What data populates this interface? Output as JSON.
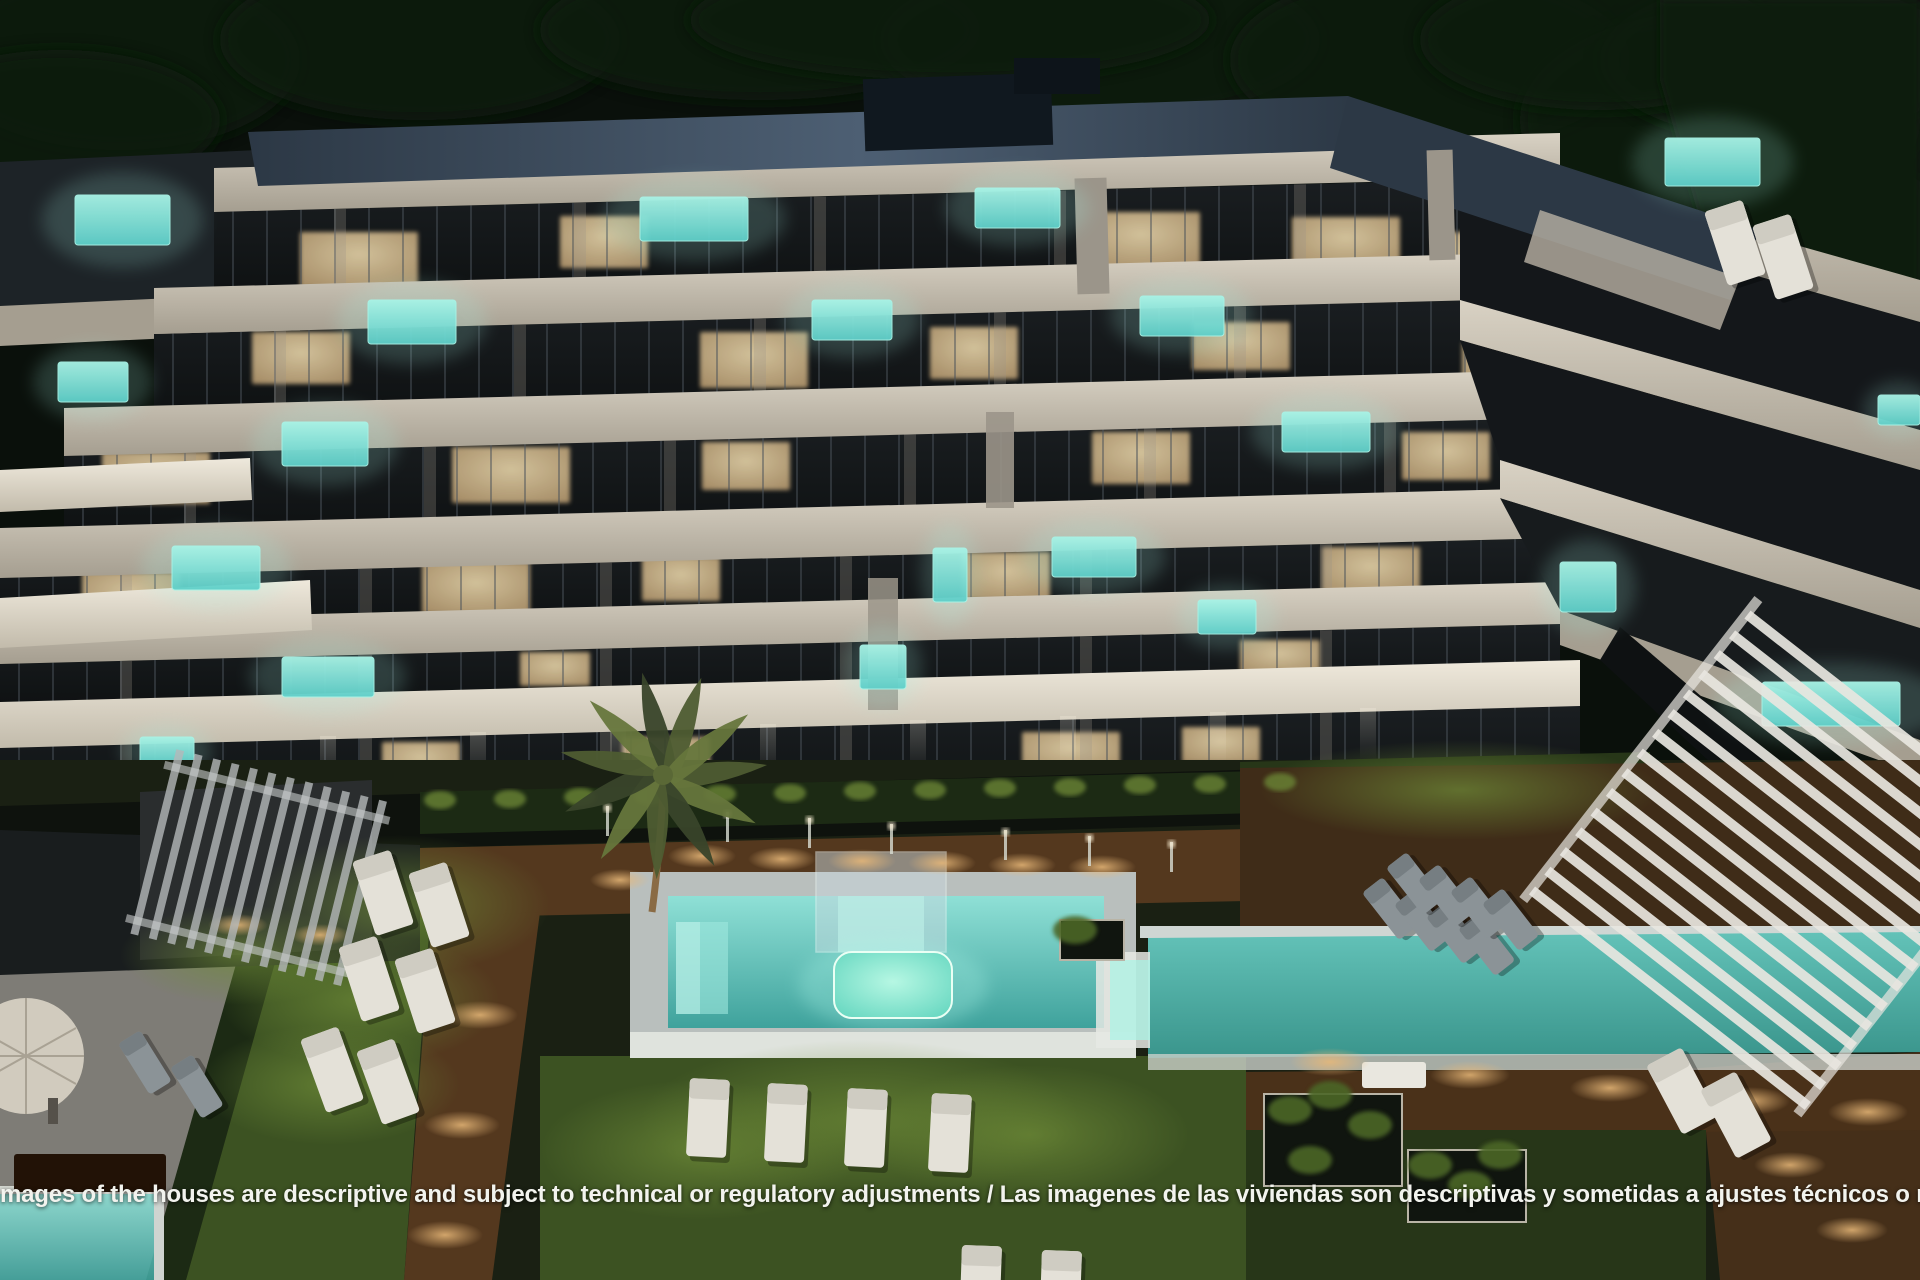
{
  "image_description": "Night aerial rendering of a modern white apartment complex with terraced balconies, plunge pools, communal swimming pools, lap pool, pergolas, palm tree, lawns and sun loungers",
  "disclaimer": {
    "text": "mages of the houses are descriptive and subject to technical or regulatory adjustments / Las imagenes de las viviendas son descriptivas y sometidas a ajustes técnicos o norm"
  },
  "palette": {
    "sky": "#0a100b",
    "tree": "#101c11",
    "roof1": "#4d5f73",
    "roof2": "#2c3845",
    "slab": "#d9d2c4",
    "slabDim": "#a59e90",
    "slabBright": "#efe9dc",
    "glass": "#14171a",
    "mullion": "#4a525a",
    "pier": "#9b958a",
    "warm1": "#e6d3a8",
    "warm2": "#b1946a",
    "pool": "#5ecfc9",
    "poolGlow": "#a8f3e6",
    "poolDeep": "#2f9b95",
    "lawn": "#3c5222",
    "lawnLit": "#5d7a2f",
    "lawnDark": "#273618",
    "deck": "#54381e",
    "deckLit": "#b9813f",
    "paving": "#7e7c76",
    "hedge": "#1c2a14",
    "hedgeLit": "#6a8434",
    "pergolaWhite": "#e8e6df",
    "pergolaGray": "#b4b8b9",
    "lounger": "#e4e1d8",
    "loungerGray": "#8b9397",
    "copingWhite": "#dfe3dd",
    "text": "#f2f3ee"
  },
  "scene": {
    "glass_bands": [
      [
        214,
        212,
        1346,
        76
      ],
      [
        154,
        334,
        1406,
        74
      ],
      [
        64,
        456,
        1496,
        72
      ],
      [
        0,
        578,
        1560,
        44
      ],
      [
        0,
        664,
        1560,
        38
      ],
      [
        0,
        746,
        1580,
        60
      ]
    ],
    "plunge_pools": [
      [
        75,
        195,
        95,
        50
      ],
      [
        640,
        197,
        108,
        44
      ],
      [
        975,
        188,
        85,
        40
      ],
      [
        1665,
        138,
        95,
        48
      ],
      [
        368,
        300,
        88,
        44
      ],
      [
        812,
        300,
        80,
        40
      ],
      [
        1140,
        296,
        84,
        40
      ],
      [
        58,
        362,
        70,
        40
      ],
      [
        282,
        422,
        86,
        44
      ],
      [
        933,
        548,
        34,
        54
      ],
      [
        1282,
        412,
        88,
        40
      ],
      [
        172,
        546,
        88,
        44
      ],
      [
        1052,
        537,
        84,
        40
      ],
      [
        860,
        645,
        46,
        44
      ],
      [
        1198,
        600,
        58,
        34
      ],
      [
        1560,
        562,
        56,
        50
      ],
      [
        1762,
        682,
        138,
        44
      ],
      [
        1878,
        395,
        42,
        30
      ],
      [
        282,
        657,
        92,
        40
      ],
      [
        140,
        737,
        54,
        28
      ]
    ],
    "lit_windows": [
      [
        300,
        232,
        118,
        56
      ],
      [
        560,
        216,
        88,
        52
      ],
      [
        1082,
        212,
        118,
        56
      ],
      [
        1292,
        217,
        108,
        52
      ],
      [
        1432,
        232,
        78,
        48
      ],
      [
        252,
        332,
        98,
        52
      ],
      [
        700,
        332,
        108,
        56
      ],
      [
        930,
        327,
        88,
        52
      ],
      [
        1192,
        322,
        98,
        48
      ],
      [
        1462,
        342,
        88,
        48
      ],
      [
        102,
        452,
        108,
        52
      ],
      [
        452,
        447,
        118,
        56
      ],
      [
        702,
        442,
        88,
        48
      ],
      [
        1092,
        432,
        98,
        52
      ],
      [
        1402,
        432,
        88,
        48
      ],
      [
        82,
        572,
        98,
        48
      ],
      [
        422,
        562,
        108,
        52
      ],
      [
        642,
        557,
        78,
        44
      ],
      [
        962,
        552,
        88,
        48
      ],
      [
        1322,
        547,
        98,
        48
      ],
      [
        520,
        652,
        70,
        34
      ],
      [
        1240,
        640,
        80,
        34
      ],
      [
        382,
        742,
        78,
        38
      ],
      [
        622,
        737,
        88,
        40
      ],
      [
        1022,
        732,
        98,
        40
      ],
      [
        1182,
        727,
        78,
        36
      ],
      [
        1700,
        472,
        88,
        44
      ],
      [
        1642,
        382,
        68,
        38
      ]
    ],
    "facade_streaks": [
      [
        320,
        736
      ],
      [
        470,
        732
      ],
      [
        610,
        728
      ],
      [
        760,
        724
      ],
      [
        910,
        720
      ],
      [
        1060,
        716
      ],
      [
        1210,
        712
      ],
      [
        1360,
        708
      ]
    ],
    "deck_lights": [
      [
        702,
        856,
        34,
        12
      ],
      [
        782,
        859,
        34,
        12
      ],
      [
        862,
        861,
        34,
        12
      ],
      [
        942,
        863,
        34,
        12
      ],
      [
        1022,
        865,
        34,
        12
      ],
      [
        1102,
        867,
        34,
        12
      ],
      [
        480,
        1015,
        38,
        14
      ],
      [
        462,
        1125,
        38,
        14
      ],
      [
        445,
        1235,
        38,
        14
      ],
      [
        1330,
        1062,
        40,
        14
      ],
      [
        1470,
        1075,
        40,
        14
      ],
      [
        1610,
        1088,
        40,
        14
      ],
      [
        1750,
        1101,
        40,
        14
      ],
      [
        1868,
        1112,
        40,
        14
      ],
      [
        1790,
        1165,
        36,
        13
      ],
      [
        1852,
        1230,
        36,
        13
      ],
      [
        238,
        925,
        30,
        11
      ],
      [
        320,
        935,
        30,
        11
      ],
      [
        620,
        880,
        30,
        11
      ]
    ],
    "light_posts": [
      [
        606,
        806
      ],
      [
        726,
        812
      ],
      [
        808,
        818
      ],
      [
        890,
        824
      ],
      [
        1004,
        830
      ],
      [
        1088,
        836
      ],
      [
        1170,
        842
      ]
    ],
    "hedge_tufts": [
      [
        440,
        800
      ],
      [
        510,
        799
      ],
      [
        580,
        797
      ],
      [
        650,
        796
      ],
      [
        720,
        794
      ],
      [
        790,
        793
      ],
      [
        860,
        791
      ],
      [
        930,
        790
      ],
      [
        1000,
        788
      ],
      [
        1070,
        787
      ],
      [
        1140,
        785
      ],
      [
        1210,
        784
      ],
      [
        1280,
        782
      ]
    ],
    "planter_tufts": [
      [
        1290,
        1110
      ],
      [
        1330,
        1095
      ],
      [
        1370,
        1125
      ],
      [
        1310,
        1160
      ],
      [
        1430,
        1165
      ],
      [
        1470,
        1185
      ],
      [
        1500,
        1155
      ],
      [
        1075,
        930
      ]
    ],
    "white_loungers": [
      [
        690,
        1078,
        3
      ],
      [
        768,
        1083,
        3
      ],
      [
        848,
        1088,
        3
      ],
      [
        932,
        1093,
        3
      ],
      [
        352,
        862,
        -18
      ],
      [
        408,
        874,
        -18
      ],
      [
        338,
        948,
        -18
      ],
      [
        394,
        960,
        -18
      ],
      [
        300,
        1040,
        -20
      ],
      [
        356,
        1052,
        -20
      ],
      [
        962,
        1245,
        2
      ],
      [
        1042,
        1250,
        2
      ],
      [
        1646,
        1066,
        -28
      ],
      [
        1700,
        1090,
        -28
      ],
      [
        1704,
        212,
        -18
      ],
      [
        1752,
        226,
        -18
      ]
    ],
    "gray_loungers": [
      [
        1362,
        893,
        -38
      ],
      [
        1394,
        905,
        -38
      ],
      [
        1426,
        917,
        -38
      ],
      [
        1458,
        929,
        -38
      ],
      [
        1386,
        868,
        -38
      ],
      [
        1418,
        880,
        -38
      ],
      [
        1450,
        892,
        -38
      ],
      [
        1482,
        904,
        -38
      ],
      [
        118,
        1044,
        -32
      ],
      [
        170,
        1068,
        -32
      ]
    ],
    "lawn_glows": [
      [
        400,
        905,
        150,
        70
      ],
      [
        360,
        1000,
        140,
        66
      ],
      [
        330,
        1085,
        130,
        60
      ],
      [
        860,
        1120,
        220,
        80
      ],
      [
        700,
        1150,
        160,
        70
      ],
      [
        1030,
        1135,
        160,
        70
      ],
      [
        1460,
        790,
        200,
        50
      ],
      [
        240,
        955,
        120,
        50
      ]
    ],
    "tree_blobs": [
      [
        120,
        60,
        180,
        90
      ],
      [
        420,
        40,
        200,
        80
      ],
      [
        760,
        30,
        220,
        70
      ],
      [
        1100,
        40,
        220,
        80
      ],
      [
        1430,
        60,
        200,
        90
      ],
      [
        1720,
        120,
        200,
        110
      ],
      [
        1850,
        320,
        140,
        160
      ],
      [
        1880,
        560,
        120,
        140
      ],
      [
        60,
        120,
        160,
        70
      ],
      [
        1780,
        60,
        180,
        80
      ],
      [
        950,
        20,
        260,
        60
      ],
      [
        1600,
        40,
        180,
        70
      ]
    ]
  }
}
